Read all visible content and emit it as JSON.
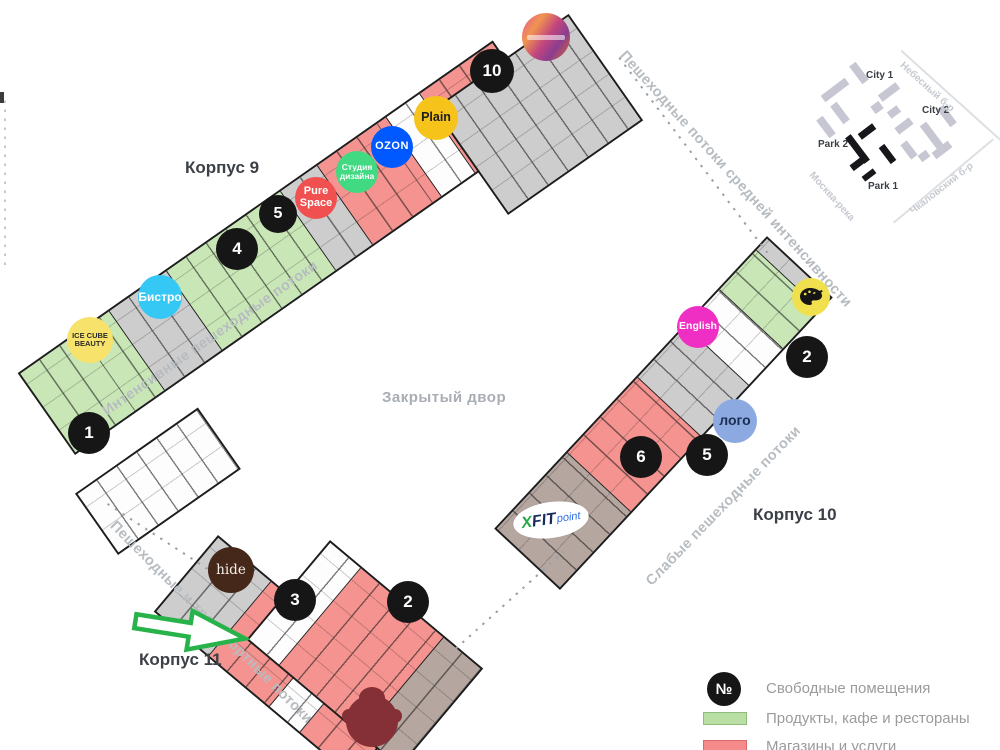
{
  "labels": {
    "korpus9": "Корпус 9",
    "korpus10": "Корпус 10",
    "korpus11": "Корпус 11",
    "courtyard": "Закрытый двор",
    "flow_intensive": "Интенсивные пешеходные потоки",
    "flow_medium": "Пешеходные потоки средней интенсивности",
    "flow_weak": "Слабые пешеходные потоки",
    "flow_transport": "Пешеходные и транспортные потоки"
  },
  "markers": {
    "k9_1": "1",
    "k9_4": "4",
    "k9_5": "5",
    "k9_10": "10",
    "k10_2": "2",
    "k10_5": "5",
    "k10_6": "6",
    "k11_2": "2",
    "k11_3": "3"
  },
  "badges": {
    "ice_cube": "ICE CUBE BEAUTY",
    "bistro": "Бистро",
    "pure_space": "Pure Space",
    "design_studio": "Студия дизайна",
    "ozon": "OZON",
    "plain": "Plain",
    "english": "English",
    "logo": "лого",
    "hide": "hide",
    "xfit_x": "X",
    "xfit_fit": "FIT",
    "xfit_point": "point"
  },
  "legend": {
    "marker_symbol": "№",
    "items": [
      {
        "label": "Свободные помещения"
      },
      {
        "label": "Продукты,  кафе и рестораны"
      },
      {
        "label": "Магазины и услуги"
      }
    ]
  },
  "minimap": {
    "city1": "City 1",
    "city2": "City 2",
    "park1": "Park 1",
    "park2": "Park 2",
    "street_nebesny": "Небесный б-р",
    "street_moskva": "Москва-река",
    "street_chkalovsky": "Чкаловский б-р"
  },
  "colors": {
    "wall": "#1d1d1d",
    "products_green": "#c9e7b6",
    "shops_red": "#f4938f",
    "common_gray": "#cdcdcd",
    "arrow_green": "#27b34a",
    "ozon_blue": "#0059ff",
    "plain_yellow": "#f6c31b",
    "bistro_cyan": "#35c8f5",
    "pure_space_red": "#f15050",
    "design_green": "#41d981",
    "english_magenta": "#ef2fc4",
    "logo_blue": "#8ca9e2",
    "hide_brown": "#46281b",
    "ice_cube_yellow": "#f7e36b",
    "palette_yellow": "#f1e04d"
  }
}
